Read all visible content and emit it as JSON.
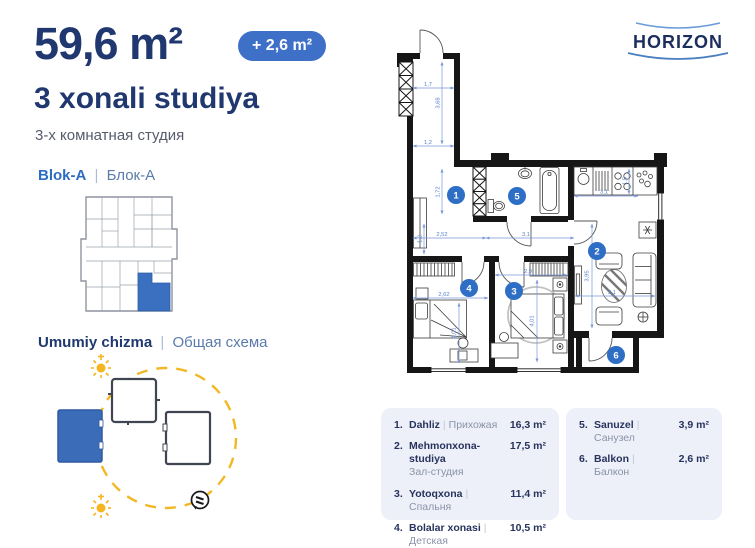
{
  "header": {
    "area": "59,6 m²",
    "badge": "+ 2,6 m²",
    "title": "3 xonali studiya",
    "subtitle_ru": "3-х комнатная студия"
  },
  "block": {
    "uz": "Blok-A",
    "sep": "|",
    "ru": "Блок-А"
  },
  "scheme": {
    "uz": "Umumiy chizma",
    "sep": "|",
    "ru": "Общая схема"
  },
  "logo": {
    "text": "HORIZON"
  },
  "plan": {
    "markers": [
      "1",
      "2",
      "3",
      "4",
      "5",
      "6"
    ],
    "dims": {
      "entry_width": "1,7",
      "entry_depth": "3,68",
      "entry_width2": "1,2",
      "hall_depth": "1,72",
      "hall_depth2": "1,2",
      "hall_width": "2,52",
      "hall_width2": "3,1",
      "kitchen_width": "3,1",
      "kitchen_depth": "1,5",
      "living_depth": "3,95",
      "living_width": "3,1",
      "bedroom_width": "2,9",
      "bedroom_depth": "4,01",
      "kids_width": "2,62",
      "kids_depth": "4,01"
    }
  },
  "legend": {
    "sep": "|",
    "items": [
      {
        "num": "1.",
        "name": "Dahliz",
        "ru": "Прихожая",
        "area": "16,3 m²"
      },
      {
        "num": "2.",
        "name": "Mehmonxona-studiya",
        "ru": "Зал-студия",
        "area": "17,5 m²"
      },
      {
        "num": "3.",
        "name": "Yotoqxona",
        "ru": "Спальня",
        "area": "11,4 m²"
      },
      {
        "num": "4.",
        "name": "Bolalar xonasi",
        "ru": "Детская",
        "area": "10,5 m²"
      },
      {
        "num": "5.",
        "name": "Sanuzel",
        "ru": "Санузел",
        "area": "3,9 m²"
      },
      {
        "num": "6.",
        "name": "Balkon",
        "ru": "Балкон",
        "area": "2,6 m²"
      }
    ]
  },
  "colors": {
    "navy": "#20386f",
    "accent_blue": "#2e6ec4",
    "badge_blue": "#3f70c8",
    "dim_blue": "#5b82cc",
    "yellow": "#f2b824",
    "legend_bg": "#edf0f8",
    "highlight_unit": "#3b6fc0"
  }
}
